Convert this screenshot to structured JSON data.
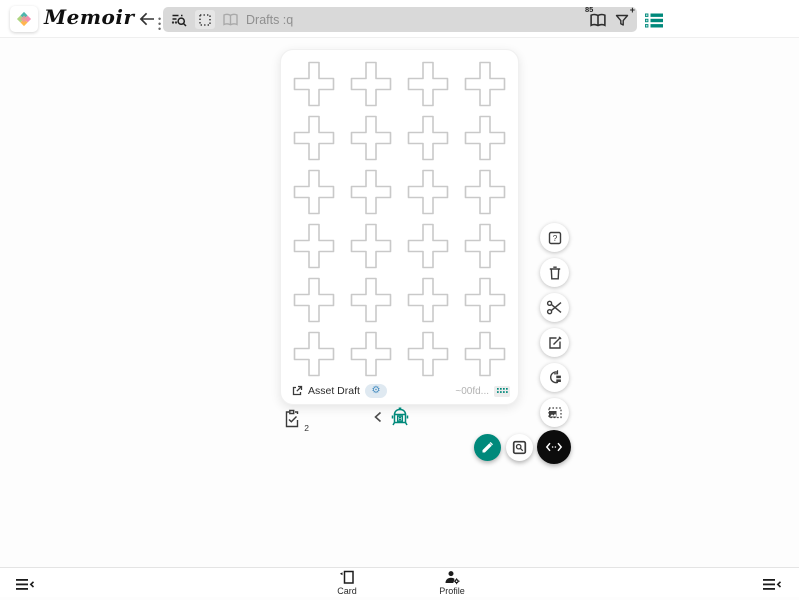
{
  "app": {
    "name": "Memoir"
  },
  "colors": {
    "accent": "#00897B",
    "gear_blue": "#4A8FC2",
    "fab_black": "#0C0C0C",
    "searchbar_bg": "#D9D9D9"
  },
  "topbar": {
    "search": {
      "query": "Drafts :q",
      "deck_count": "85",
      "filter_badge": "+"
    },
    "icons": [
      "back-arrow",
      "drag-dots",
      "manage-search",
      "dashed-selection",
      "book",
      "book-with-count",
      "filter-plus",
      "list-status"
    ]
  },
  "card": {
    "label": "Asset Draft",
    "id_text": "~00fd...",
    "gear_glyph": "⚙",
    "grid": {
      "rows": 6,
      "cols": 4
    }
  },
  "under_card": {
    "badge_count": "2",
    "icons": [
      "clipboard-check",
      "chevron-left",
      "lantern"
    ]
  },
  "right_toolbar": {
    "icons": [
      "help-box",
      "trash",
      "scissors",
      "edit-box",
      "swap-restore",
      "image-select"
    ]
  },
  "fabs": {
    "icons": [
      "pencil",
      "zoom-box",
      "code-expand"
    ]
  },
  "bottom_nav": {
    "tabs": [
      {
        "label": "Card"
      },
      {
        "label": "Profile"
      }
    ],
    "icons": [
      "menu-collapse-left",
      "card-tab",
      "profile-gear",
      "menu-collapse-right"
    ]
  }
}
